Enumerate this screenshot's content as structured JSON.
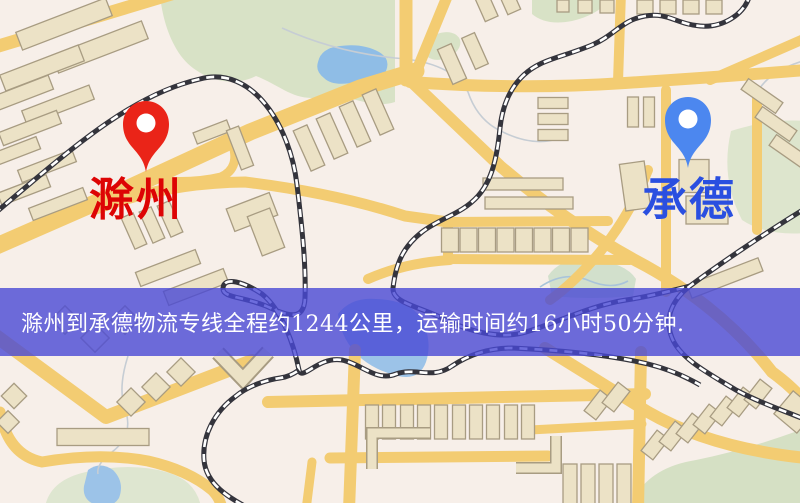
{
  "map": {
    "markers": {
      "origin": {
        "name": "滁州",
        "icon": "map-pin",
        "pin_color": "#ea2418",
        "label_color": "#dd0404"
      },
      "destination": {
        "name": "承德",
        "icon": "map-pin",
        "pin_color": "#4c87ef",
        "label_color": "#2a4fe0"
      }
    },
    "palette": {
      "background": "#f7efe9",
      "road": "#f3cc72",
      "building_fill": "#ece2c6",
      "building_outline": "#a89c82",
      "green_area": "#d8e2c6",
      "water": "#a6cbe9",
      "railway": "#34343c"
    }
  },
  "banner": {
    "text": "滁州到承德物流专线全程约1244公里，运输时间约16小时50分钟.",
    "background": "#4848d4",
    "text_color": "#ffffff",
    "route": {
      "origin": "滁州",
      "destination": "承德",
      "service": "物流专线",
      "distance_km": "1244",
      "duration": "16小时50分钟"
    }
  }
}
